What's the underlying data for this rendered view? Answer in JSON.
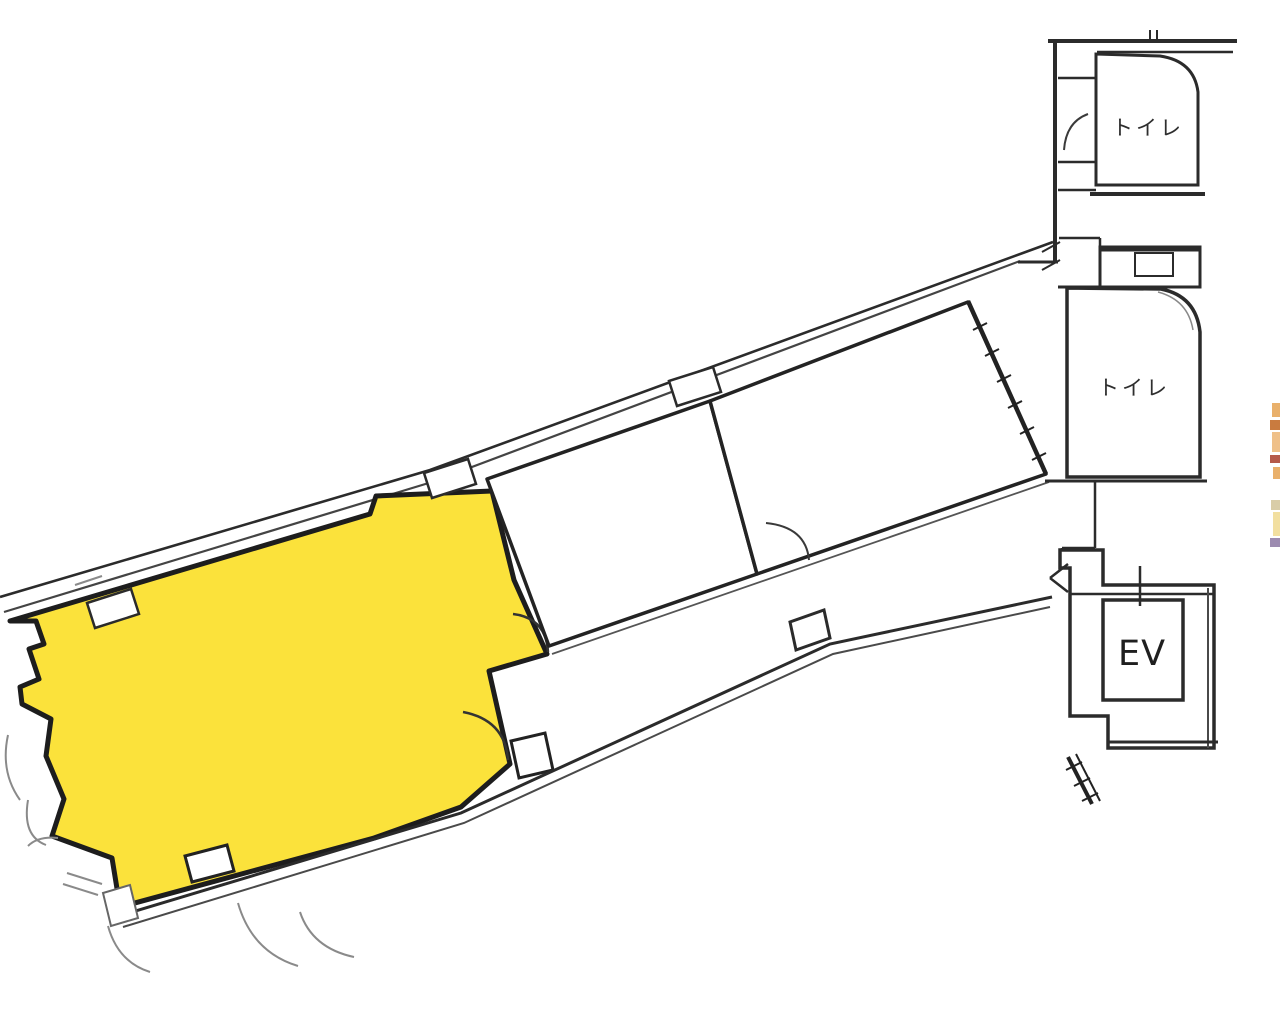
{
  "plan": {
    "kind": "building-floor-plan",
    "labels": {
      "toilet_upper": "トイレ",
      "toilet_lower": "トイレ",
      "elevator": "EV"
    },
    "colors": {
      "highlight_unit_fill": "#FBE23B",
      "wall_line": "#2b2b2b",
      "faint_line": "#8a8a8a",
      "edge_fragment_primary": "#E9B06B",
      "edge_fragment_dark": "#B65A4A"
    }
  }
}
